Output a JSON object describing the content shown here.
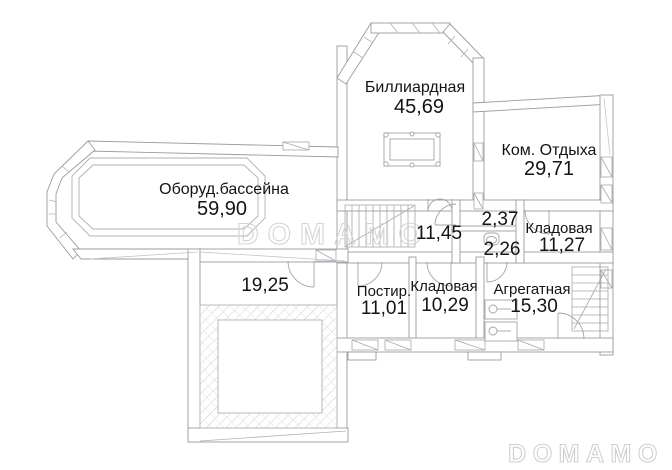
{
  "plan": {
    "rooms": [
      {
        "name": "Биллиардная",
        "area": "45,69"
      },
      {
        "name": "Ком. Отдыха",
        "area": "29,71"
      },
      {
        "name": "Оборуд.бассейна",
        "area": "59,90"
      },
      {
        "name": "",
        "area": "11,45"
      },
      {
        "name": "",
        "area": "19,25"
      },
      {
        "name": "",
        "area": "2,37"
      },
      {
        "name": "",
        "area": "2,26"
      },
      {
        "name": "Кладовая",
        "area": "11,27"
      },
      {
        "name": "Постир.",
        "area": "11,01"
      },
      {
        "name": "Кладовая",
        "area": "10,29"
      },
      {
        "name": "Агрегатная",
        "area": "15,30"
      }
    ],
    "watermark": {
      "center": "DOMAMO",
      "bottom_right": "DOMAMO"
    },
    "colors": {
      "line": "#9b9ba1",
      "light_line": "#bcbcc2",
      "text": "#141414",
      "watermark": "#d4d4d8",
      "background": "#ffffff"
    }
  }
}
